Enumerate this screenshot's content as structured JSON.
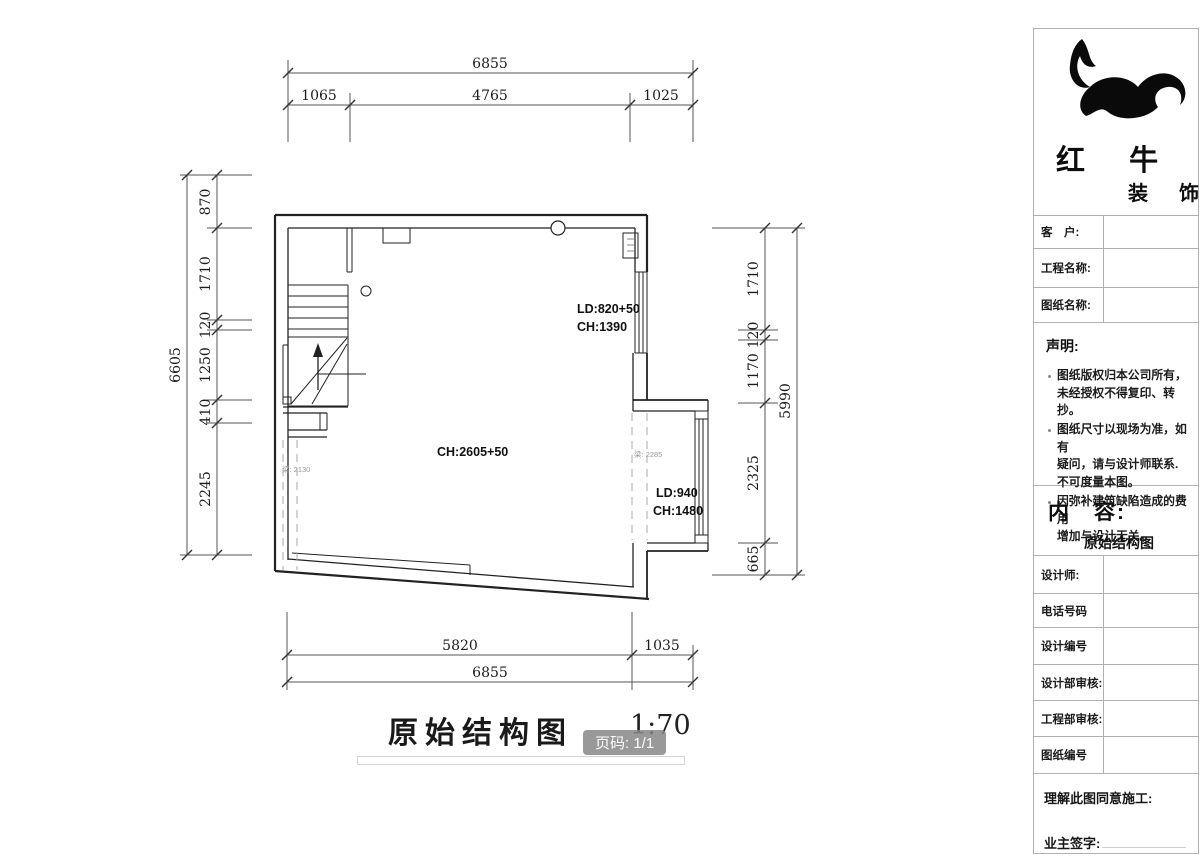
{
  "title_area": {
    "title": "原始结构图",
    "scale": "1:70",
    "page_badge": "页码: 1/1"
  },
  "brand": {
    "name_top": "红 牛",
    "name_bottom": "装 饰"
  },
  "side_panel": {
    "customer_label": "客　户:",
    "project_label": "工程名称:",
    "drawing_label": "图纸名称:",
    "statement_title": "声明:",
    "statement_items": [
      "图纸版权归本公司所有，\n未经授权不得复印、转抄。",
      "图纸尺寸以现场为准，如有\n疑问，请与设计师联系.\n不可度量本图。",
      "因弥补建筑缺陷造成的费用\n增加与设计无关。"
    ],
    "content_label": "内　容:",
    "content_value": "原始结构图",
    "designer_label": "设计师:",
    "phone_label": "电话号码",
    "design_no_label": "设计编号",
    "design_review_label": "设计部审核:",
    "eng_review_label": "工程部审核:",
    "drawing_no_label": "图纸编号",
    "agreement_label": "理解此图同意施工:",
    "owner_sign_label": "业主签字:"
  },
  "plan": {
    "labels": {
      "win_top_ld": "LD:820+50",
      "win_top_ch": "CH:1390",
      "room_ch": "CH:2605+50",
      "win_right_ld": "LD:940",
      "win_right_ch": "CH:1480",
      "beam_left": "梁: 2130",
      "beam_right": "梁: 2285"
    },
    "dims": {
      "top_overall": "6855",
      "top_chain": [
        "1065",
        "4765",
        "1025"
      ],
      "left_overall": "6605",
      "left_chain": [
        "870",
        "1710",
        "120",
        "1250",
        "410",
        "2245"
      ],
      "right_overall": "5990",
      "right_chain": [
        "1710",
        "120",
        "1170",
        "2325",
        "665"
      ],
      "bottom_chain": [
        "5820",
        "1035"
      ],
      "bottom_overall": "6855"
    }
  }
}
